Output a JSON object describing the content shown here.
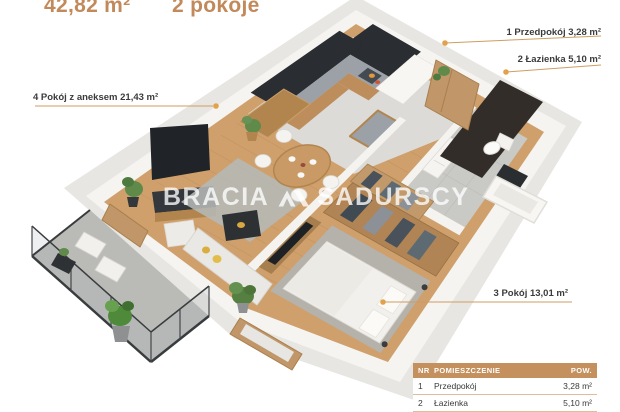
{
  "header": {
    "area_value": "42,82 m²",
    "rooms_value": "2 pokoje"
  },
  "plan_labels": {
    "room4": "4 Pokój z aneksem 21,43 m²",
    "room1": "1 Przedpokój 3,28 m²",
    "room2": "2 Łazienka 5,10 m²",
    "room3": "3 Pokój 13,01 m²"
  },
  "watermark": {
    "brand_left": "BRACIA",
    "brand_right": "SADURSCY"
  },
  "legend_table": {
    "col_nr": "NR",
    "col_name": "POMIESZCZENIE",
    "col_area": "POW.",
    "rows": [
      {
        "nr": "1",
        "name": "Przedpokój",
        "area": "3,28 m²"
      },
      {
        "nr": "2",
        "name": "Łazienka",
        "area": "5,10 m²"
      }
    ]
  },
  "colors": {
    "accent_gold": "#c4905d",
    "title_gold": "#c2895a",
    "leader_line": "#cf9d62",
    "leader_dot": "#e2a24c",
    "wood_floor": "#cfa06c",
    "dark_cabinet": "#2a2d31"
  }
}
